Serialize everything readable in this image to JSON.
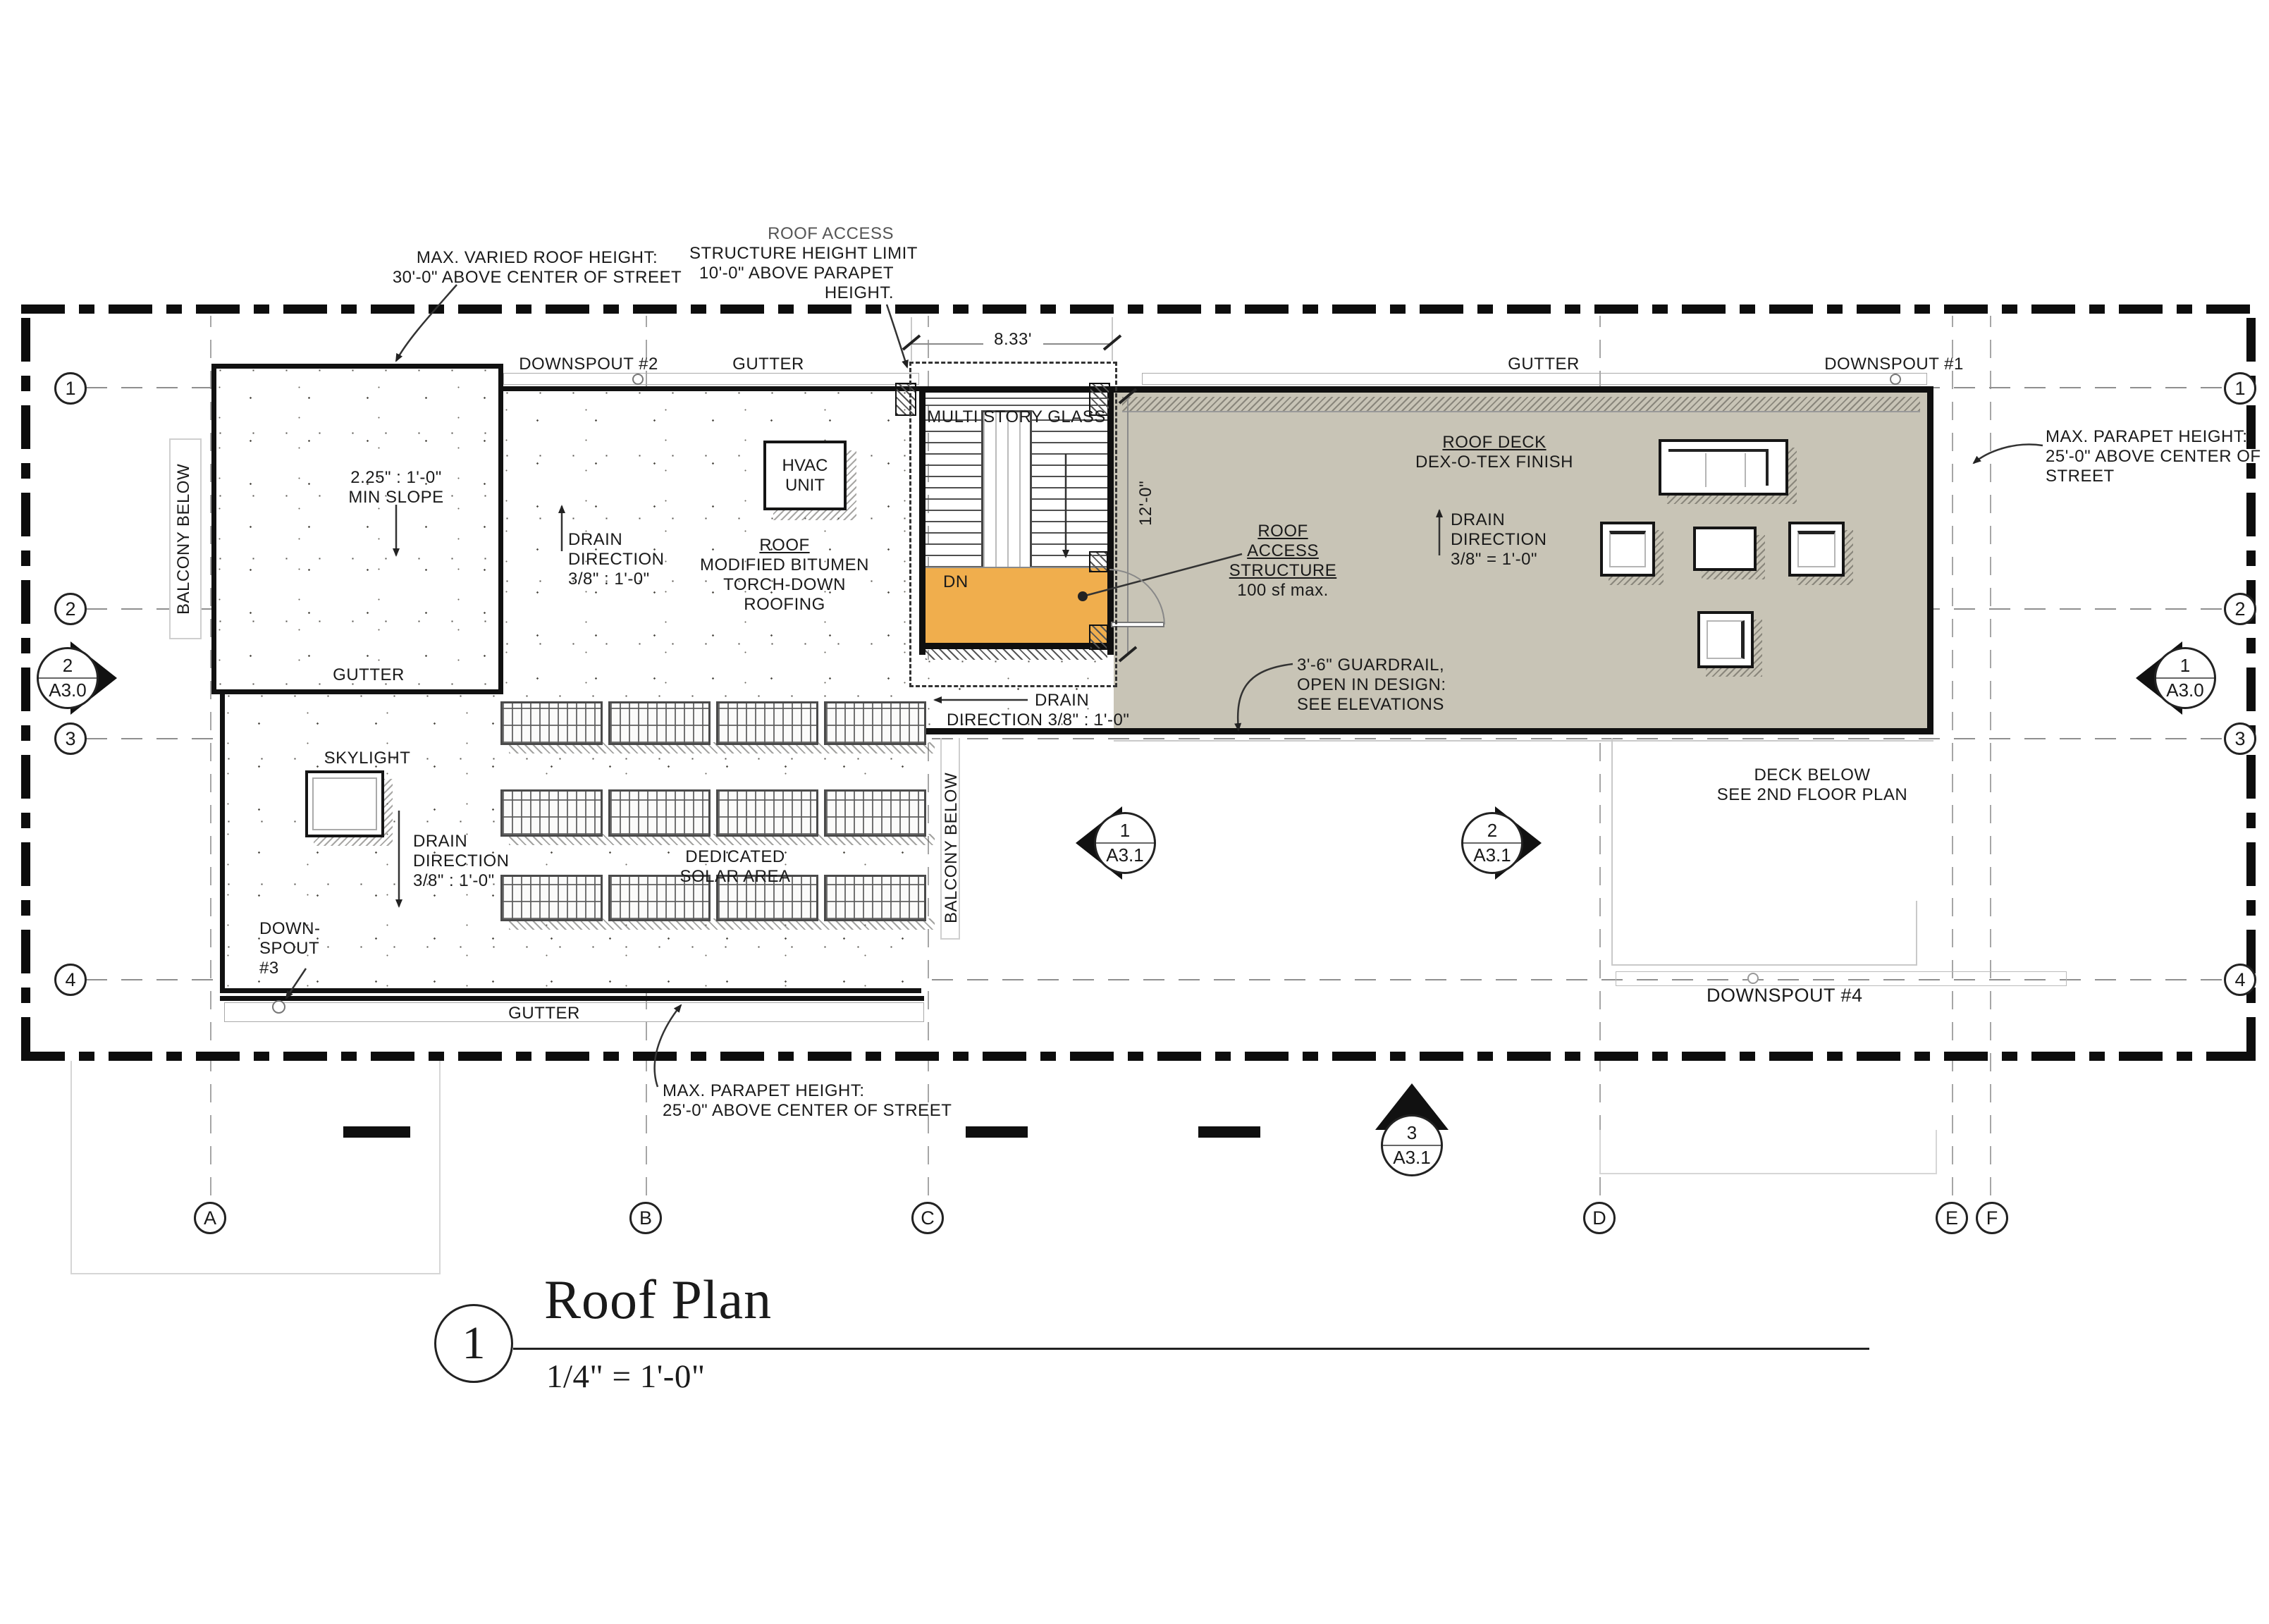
{
  "colors": {
    "deck": "#c8c4b6",
    "landing": "#f0ae4d",
    "ink": "#1a1a1a"
  },
  "title_block": {
    "number": "1",
    "title": "Roof Plan",
    "scale": "1/4\" = 1'-0\""
  },
  "grid": {
    "cols": [
      "A",
      "B",
      "C",
      "D",
      "E",
      "F"
    ],
    "rows": [
      "1",
      "2",
      "3",
      "4"
    ]
  },
  "markers": {
    "left": {
      "num": "2",
      "sheet": "A3.0"
    },
    "right": {
      "num": "1",
      "sheet": "A3.0"
    },
    "mid_left": {
      "num": "1",
      "sheet": "A3.1"
    },
    "mid_right": {
      "num": "2",
      "sheet": "A3.1"
    },
    "bottom": {
      "num": "3",
      "sheet": "A3.1"
    }
  },
  "dimensions": {
    "stair": "8.33'",
    "deck": "12'-0\""
  },
  "ann": {
    "max_varied": [
      "MAX. VARIED ROOF HEIGHT:",
      "30'-0\" ABOVE CENTER OF STREET"
    ],
    "access_limit": [
      "ROOF ACCESS",
      "STRUCTURE HEIGHT LIMIT",
      "10'-0\" ABOVE PARAPET",
      "HEIGHT."
    ],
    "downspout2": "DOWNSPOUT #2",
    "gutter": "GUTTER",
    "downspout1": "DOWNSPOUT #1",
    "multi_story_glass": "MULTI STORY GLASS",
    "parapet_right": [
      "MAX. PARAPET HEIGHT:",
      "25'-0\" ABOVE CENTER OF",
      "STREET"
    ],
    "roof_deck": [
      "ROOF DECK",
      "DEX-O-TEX FINISH"
    ],
    "drain_deck": [
      "DRAIN",
      "DIRECTION",
      "3/8\" = 1'-0\""
    ],
    "access_structure": [
      "ROOF",
      "ACCESS",
      "STRUCTURE",
      "100 sf max."
    ],
    "dn": "DN",
    "guardrail": [
      "3'-6\" GUARDRAIL,",
      "OPEN IN DESIGN:",
      "SEE ELEVATIONS"
    ],
    "drain_bottom": [
      "DRAIN",
      "DIRECTION 3/8\" : 1'-0\""
    ],
    "deck_below": [
      "DECK BELOW",
      "SEE 2ND FLOOR PLAN"
    ],
    "balcony_below": "BALCONY BELOW",
    "min_slope": [
      "2.25\" : 1'-0\"",
      "MIN SLOPE"
    ],
    "drain_left": [
      "DRAIN",
      "DIRECTION",
      "3/8\" : 1'-0\""
    ],
    "roof_type": [
      "ROOF",
      "MODIFIED BITUMEN",
      "TORCH-DOWN",
      "ROOFING"
    ],
    "hvac": [
      "HVAC",
      "UNIT"
    ],
    "skylight": "SKYLIGHT",
    "drain_sky": [
      "DRAIN",
      "DIRECTION",
      "3/8\" : 1'-0\""
    ],
    "solar": [
      "DEDICATED",
      "SOLAR AREA"
    ],
    "downspout3": [
      "DOWN-",
      "SPOUT",
      "#3"
    ],
    "downspout4": "DOWNSPOUT #4",
    "parapet_bottom": [
      "MAX. PARAPET HEIGHT:",
      "25'-0\" ABOVE CENTER OF STREET"
    ]
  }
}
